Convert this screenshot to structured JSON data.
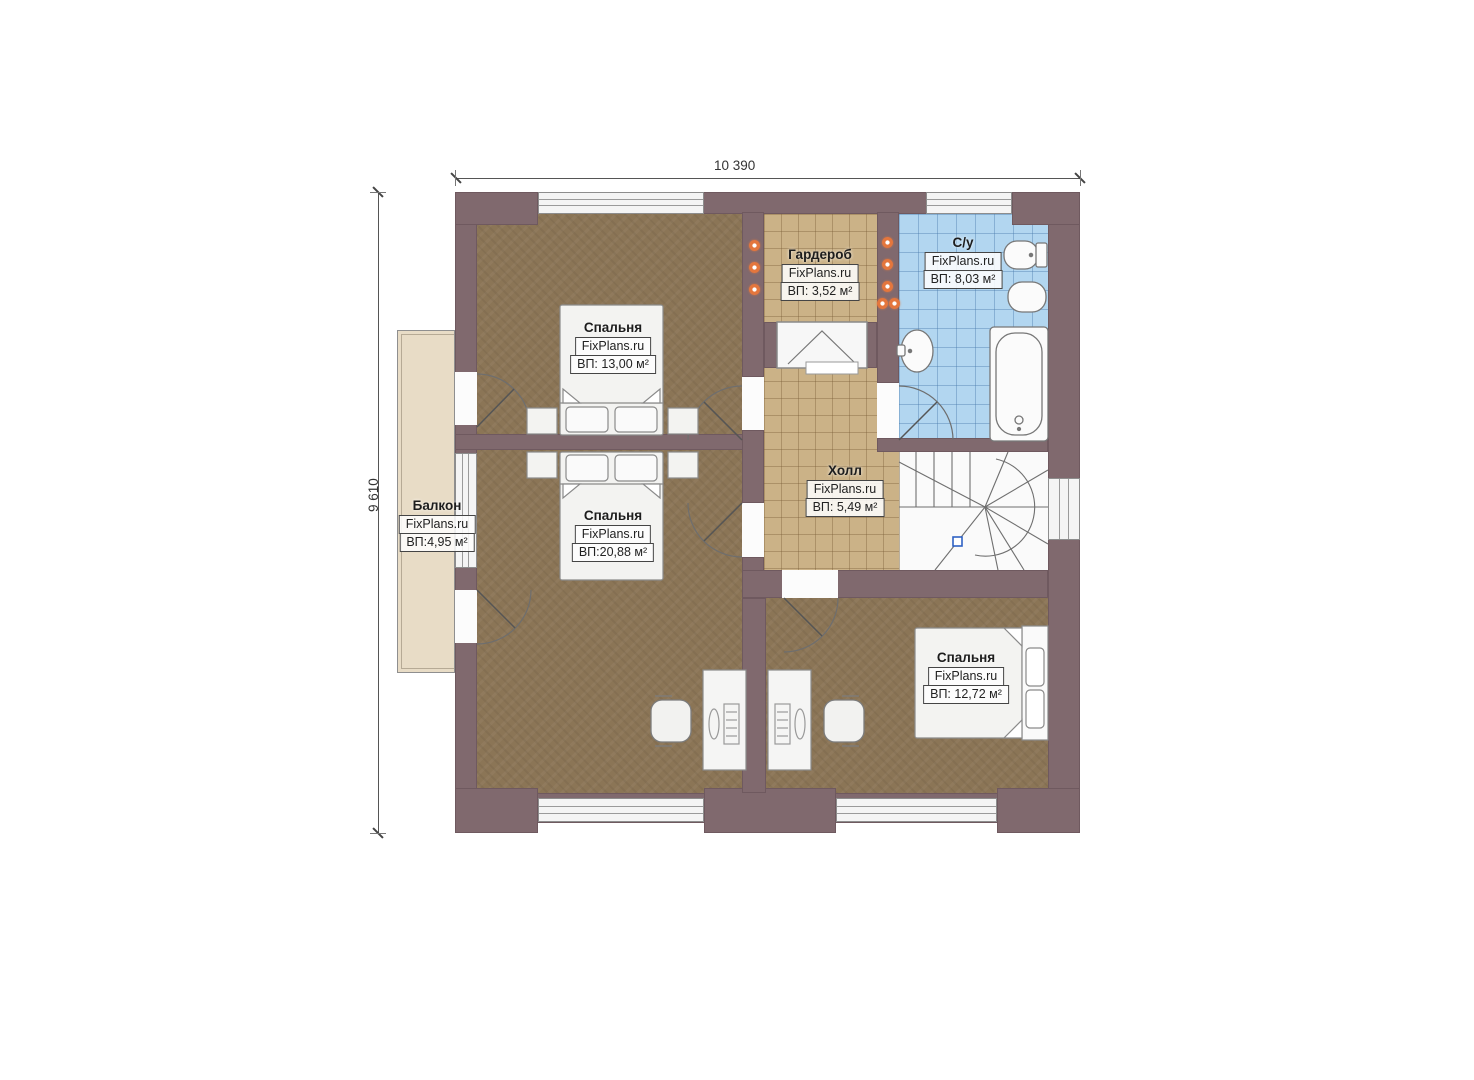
{
  "title": "Floor plan — second storey",
  "brand": "FixPlans.ru",
  "dimensions": {
    "width_label": "10 390",
    "height_label": "9 610"
  },
  "rooms": [
    {
      "id": "bedroom1",
      "name": "Спальня",
      "area": "ВП: 13,00 м²"
    },
    {
      "id": "bedroom2",
      "name": "Спальня",
      "area": "ВП:20,88 м²"
    },
    {
      "id": "wardrobe",
      "name": "Гардероб",
      "area": "ВП: 3,52 м²"
    },
    {
      "id": "bathroom",
      "name": "С/у",
      "area": "ВП: 8,03 м²"
    },
    {
      "id": "hall",
      "name": "Холл",
      "area": "ВП: 5,49 м²"
    },
    {
      "id": "bedroom3",
      "name": "Спальня",
      "area": "ВП: 12,72 м²"
    },
    {
      "id": "balcony",
      "name": "Балкон",
      "area": "ВП:4,95 м²"
    }
  ],
  "colors": {
    "wall": "#80696e",
    "floor_wood": "#8b7556",
    "tile_tan": "#cbb287",
    "tile_blue": "#b2d6f0",
    "balcony_floor": "#e8dcc6",
    "light_orange": "#e4763d",
    "stair_marker_blue": "#2f62c4"
  }
}
